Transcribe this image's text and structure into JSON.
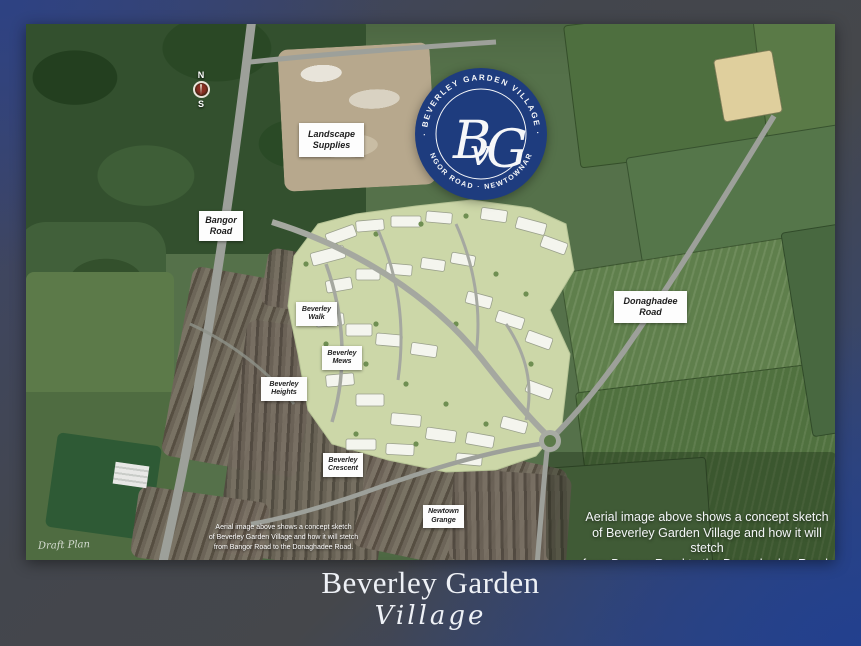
{
  "logo": {
    "arc_top": "· BEVERLEY GARDEN VILLAGE ·",
    "arc_bottom": "BANGOR ROAD · NEWTOWNARDS",
    "monogram_b": "B",
    "monogram_v": "v",
    "monogram_g": "G",
    "bg_color": "#1e3c7e"
  },
  "compass": {
    "north": "N",
    "south": "S"
  },
  "map_labels": [
    {
      "id": "landscape-supplies",
      "line1": "Landscape",
      "line2": "Supplies"
    },
    {
      "id": "bangor-road",
      "line1": "Bangor",
      "line2": "Road"
    },
    {
      "id": "donaghadee-road",
      "line1": "Donaghadee",
      "line2": "Road"
    },
    {
      "id": "beverley-walk",
      "line1": "Beverley",
      "line2": "Walk"
    },
    {
      "id": "beverley-mews",
      "line1": "Beverley",
      "line2": "Mews"
    },
    {
      "id": "beverley-heights",
      "line1": "Beverley",
      "line2": "Heights"
    },
    {
      "id": "beverley-crescent",
      "line1": "Beverley",
      "line2": "Crescent"
    },
    {
      "id": "newtown-grange",
      "line1": "Newtown",
      "line2": "Grange"
    }
  ],
  "captions": {
    "draft_plan": "Draft Plan",
    "small": {
      "line1": "Aerial image above shows a concept sketch",
      "line2": "of Beverley Garden Village and how it will stetch",
      "line3": "from Bangor Road to the Donaghadee Road."
    },
    "large": {
      "line1": "Aerial image above shows a concept sketch",
      "line2": "of Beverley Garden Village and how it will stetch",
      "line3": "from Bangor Road to the Donaghadee Road."
    }
  },
  "footer": {
    "wordmark_line1": "Beverley Garden",
    "wordmark_line2": "Village"
  },
  "colors": {
    "frame_blue": "#2b4488",
    "frame_gray": "#45474b",
    "logo_navy": "#1e3c7e",
    "label_bg": "#fdfdfd",
    "label_text": "#1c1c1c",
    "sketch_base": "#ccd7a8"
  }
}
